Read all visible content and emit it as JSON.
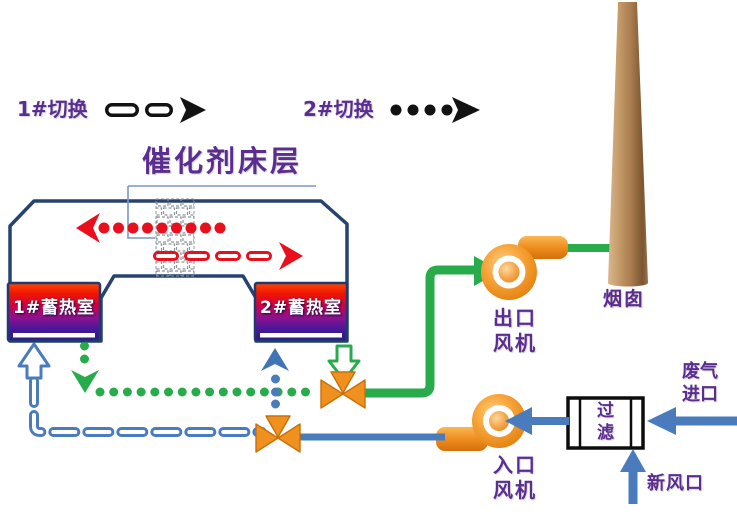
{
  "legend": {
    "switch1": "1#切换",
    "switch2": "2#切换"
  },
  "title": "催化剂床层",
  "regenerators": {
    "bed1": "1#蓄热室",
    "bed2": "2#蓄热室"
  },
  "fans": {
    "outlet": {
      "line1": "出口",
      "line2": "风机"
    },
    "inlet": {
      "line1": "入口",
      "line2": "风机"
    }
  },
  "stack_label": "烟囱",
  "filter": {
    "line1": "过",
    "line2": "滤"
  },
  "io": {
    "waste_gas": {
      "line1": "废气",
      "line2": "进口"
    },
    "fresh_air": "新风口"
  },
  "colors": {
    "text_purple": "#5b2d90",
    "chamber_navy": "#25436e",
    "flow_red": "#e90f1d",
    "flow_green": "#27ab4b",
    "flow_blue": "#4a7cbd",
    "equipment_orange": "#f0901f",
    "chimney_brown": "#a87c4e",
    "legend_black": "#121212"
  }
}
